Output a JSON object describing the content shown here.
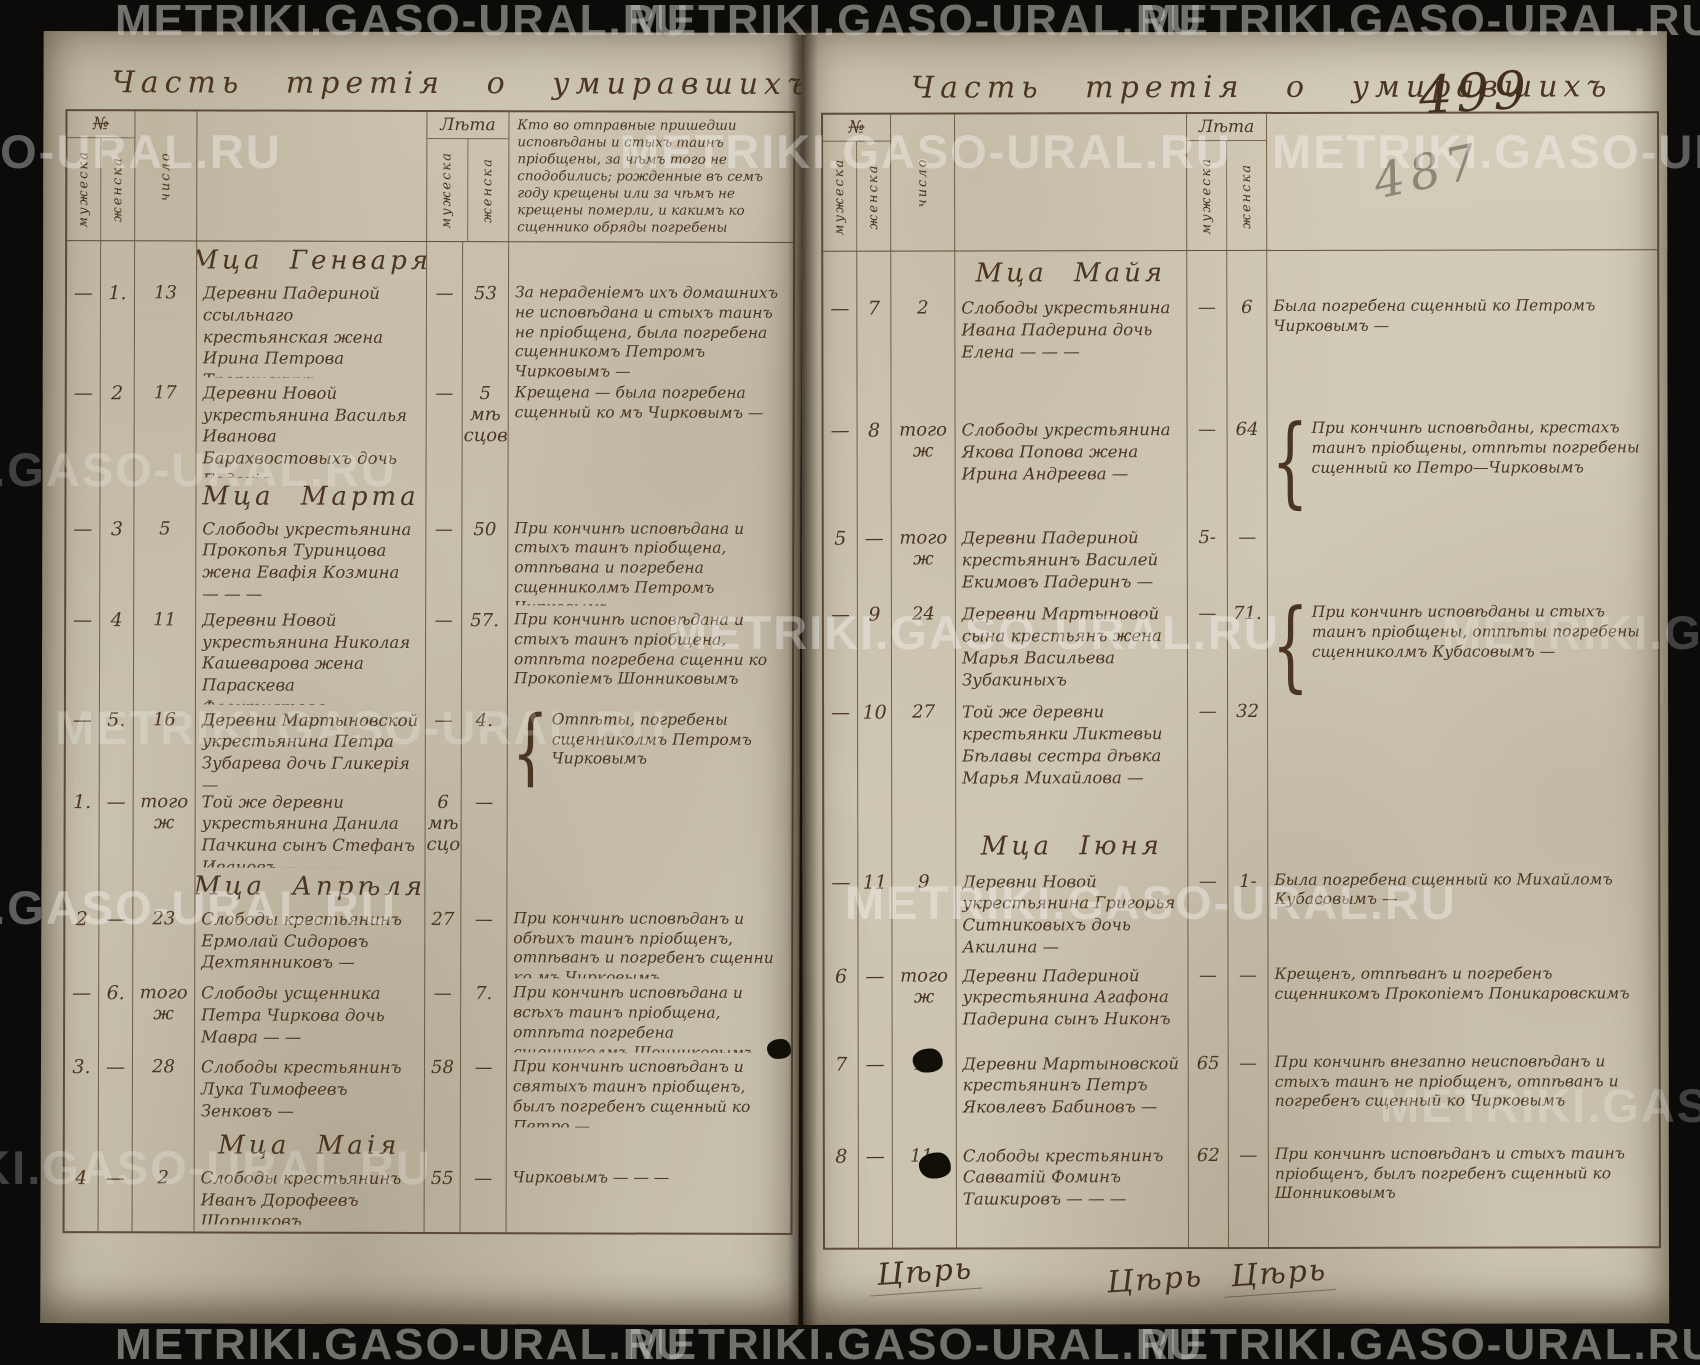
{
  "watermark": {
    "text": "METRIKI.GASO-URAL.RU"
  },
  "page_left": {
    "title": "Часть третія о умиравшихъ",
    "header": {
      "no": "№",
      "male": "мужеска",
      "female": "женска",
      "day": "число",
      "age": "Лѣта",
      "age_male": "мужеска",
      "age_female": "женска",
      "burial": "Кто во отправные пришедши исповѣданы и стыхъ таинъ пріобщены, за чѣмъ того не сподобились; рожденные въ семъ году крещены или за чѣмъ не крещены померли, и какимъ ко сщеннико обряды погребены"
    },
    "months": {
      "january": "Мца Генваря",
      "march": "Мца Марта",
      "april": "Мца Апрѣля",
      "may": "Мца Маія"
    },
    "brace": "{",
    "rows": [
      {
        "m": "—",
        "f": "1.",
        "d": "13",
        "desc": "Деревни Падериной ссыльнаго крестьянская жена Ирина Петрова Тропинскихъ — —",
        "am": "—",
        "af": "53",
        "note": "За нераденіемъ ихъ домашнихъ не исповѣдана и стыхъ таинъ не пріобщена, была погребена сщенникомъ Петромъ Чирковымъ —"
      },
      {
        "m": "—",
        "f": "2",
        "d": "17",
        "desc": "Деревни Новой укрестьянина Василья Иванова Барахвостовыхъ дочь Евдокія —",
        "am": "—",
        "af": "5 мѣ сцовъ",
        "note": "Крещена — была погребена сщенный ко мъ Чирковымъ —"
      },
      {
        "m": "—",
        "f": "3",
        "d": "5",
        "desc": "Слободы укрестьянина Прокопья Туринцова жена Евафія Козмина — — —",
        "am": "—",
        "af": "50",
        "note": "При кончинѣ исповѣдана и стыхъ таинъ пріобщена, отпѣвана и погребена сщенниколмъ Петромъ Чирковымъ"
      },
      {
        "m": "—",
        "f": "4",
        "d": "11",
        "desc": "Деревни Новой укрестьянина Николая Кашеварова жена Параскева Феоктистова —",
        "am": "—",
        "af": "57.",
        "note": "При кончинѣ исповѣдана и стыхъ таинъ пріобщена, отпѣта погребена сщенни ко Прокопіемъ Шонниковымъ"
      },
      {
        "m": "—",
        "f": "5.",
        "d": "16",
        "desc": "Деревни Мартыновской укрестьянина Петра Зубарева дочь Гликерія —",
        "am": "—",
        "af": "4.",
        "note": "Отпѣты, погребены сщенниколмъ Петромъ Чирковымъ"
      },
      {
        "m": "1.",
        "f": "—",
        "d": "того ж",
        "desc": "Той же деревни укрестьянина Данила Пачкина сынъ Стефанъ Ивановъ — — —",
        "am": "6 мѣ сцовъ",
        "af": "—",
        "note": ""
      },
      {
        "m": "2",
        "f": "—",
        "d": "23",
        "desc": "Слободы крестьянинъ Ермолай Сидоровъ Дехтянниковъ —",
        "am": "27",
        "af": "—",
        "note": "При кончинѣ исповѣданъ и обѣихъ таинъ пріобщенъ, отпѣванъ и погребенъ сщенни ко мъ Чирковымъ"
      },
      {
        "m": "—",
        "f": "6.",
        "d": "того ж",
        "desc": "Слободы усщенника Петра Чиркова дочь Мавра — —",
        "am": "—",
        "af": "7.",
        "note": "При кончинѣ исповѣдана и всѣхъ таинъ пріобщена, отпѣта погребена сщенниколмъ Шонниковымъ"
      },
      {
        "m": "3.",
        "f": "—",
        "d": "28",
        "desc": "Слободы крестьянинъ Лука Тимофеевъ Зенковъ —",
        "am": "58",
        "af": "—",
        "note": "При кончинѣ исповѣданъ и святыхъ таинъ пріобщенъ, былъ погребенъ сщенный ко Петро —"
      },
      {
        "m": "4",
        "f": "—",
        "d": "2",
        "desc": "Слободы крестьянинъ Иванъ Дорофеевъ Шорниковъ",
        "am": "55",
        "af": "—",
        "note": "Чирковымъ — — —"
      }
    ]
  },
  "page_right": {
    "title": "Часть третія о умиравшихъ",
    "page_number_ink": "499",
    "page_number_pencil": "487",
    "header": {
      "no": "№",
      "male": "мужеска",
      "female": "женска",
      "day": "число",
      "age": "Лѣта",
      "age_male": "мужеска",
      "age_female": "женска"
    },
    "months": {
      "may": "Мца Майя",
      "june": "Мца Іюня"
    },
    "brace": "{",
    "rows": [
      {
        "m": "—",
        "f": "7",
        "d": "2",
        "desc": "Слободы укрестьянина Ивана Падерина дочь Елена — — —",
        "am": "—",
        "af": "6",
        "note": "Была погребена сщенный ко Петромъ Чирковымъ —"
      },
      {
        "m": "—",
        "f": "8",
        "d": "того ж",
        "desc": "Слободы укрестьянина Якова Попова жена Ирина Андреева —",
        "am": "—",
        "af": "64",
        "note": "При кончинѣ исповѣданы, крестахъ таинъ пріобщены, отпѣты погребены сщенный ко Петро—Чирковымъ"
      },
      {
        "m": "5",
        "f": "—",
        "d": "того ж",
        "desc": "Деревни Падериной крестьянинъ Василей Екимовъ Падеринъ —",
        "am": "5-",
        "af": "—",
        "note": ""
      },
      {
        "m": "—",
        "f": "9",
        "d": "24",
        "desc": "Деревни Мартыновой сына крестьянъ жена Марья Васильева Зубакиныхъ",
        "am": "—",
        "af": "71.",
        "note": "При кончинѣ исповѣданы и стыхъ таинъ пріобщены, отпѣты погребены сщенниколмъ Кубасовымъ —"
      },
      {
        "m": "—",
        "f": "10",
        "d": "27",
        "desc": "Той же деревни крестьянки Ликтевьи Бѣлавы сестра дѣвка Марья Михайлова —",
        "am": "—",
        "af": "32",
        "note": ""
      },
      {
        "m": "—",
        "f": "11",
        "d": "9",
        "desc": "Деревни Новой укрестьянина Григорья Ситниковыхъ дочь Акилина —",
        "am": "—",
        "af": "1-",
        "note": "Была погребена сщенный ко Михайломъ Кубасовымъ —"
      },
      {
        "m": "6",
        "f": "—",
        "d": "того ж",
        "desc": "Деревни Падериной укрестьянина Агафона Падерина сынъ Никонъ",
        "am": "—",
        "af": "—",
        "note": "Крещенъ, отпѣванъ и погребенъ сщенникомъ Прокопіемъ Поникаровскимъ"
      },
      {
        "m": "7",
        "f": "—",
        "d": "10",
        "desc": "Деревни Мартыновской крестьянинъ Петръ Яковлевъ Бабиновъ —",
        "am": "65",
        "af": "—",
        "note": "При кончинѣ внезапно неисповѣданъ и стыхъ таинъ не пріобщенъ, отпѣванъ и погребенъ сщенный ко Чирковымъ"
      },
      {
        "m": "8",
        "f": "—",
        "d": "11.",
        "desc": "Слободы крестьянинъ Савватій Фоминъ Ташкировъ — — —",
        "am": "62",
        "af": "—",
        "note": "При кончинѣ исповѣданъ и стыхъ таинъ пріобщенъ, былъ погребенъ сщенный ко Шонниковымъ"
      }
    ],
    "signatures": [
      "Цѣрь",
      "Цѣрь",
      "Цѣрь"
    ]
  }
}
